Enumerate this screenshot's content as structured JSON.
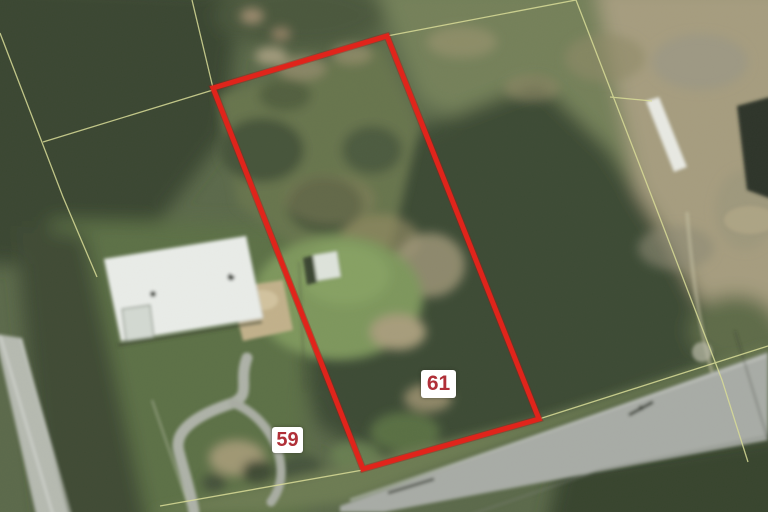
{
  "map": {
    "view": "aerial-photo",
    "labels": {
      "parcel_61": "61",
      "parcel_59": "59"
    },
    "colors": {
      "parcel_outline": "#e0241b",
      "parcel_outline_edge": "#a31510",
      "label_background": "#ffffff",
      "label_text": "#b02f38",
      "cadastral_line": "#d9dc97"
    }
  }
}
